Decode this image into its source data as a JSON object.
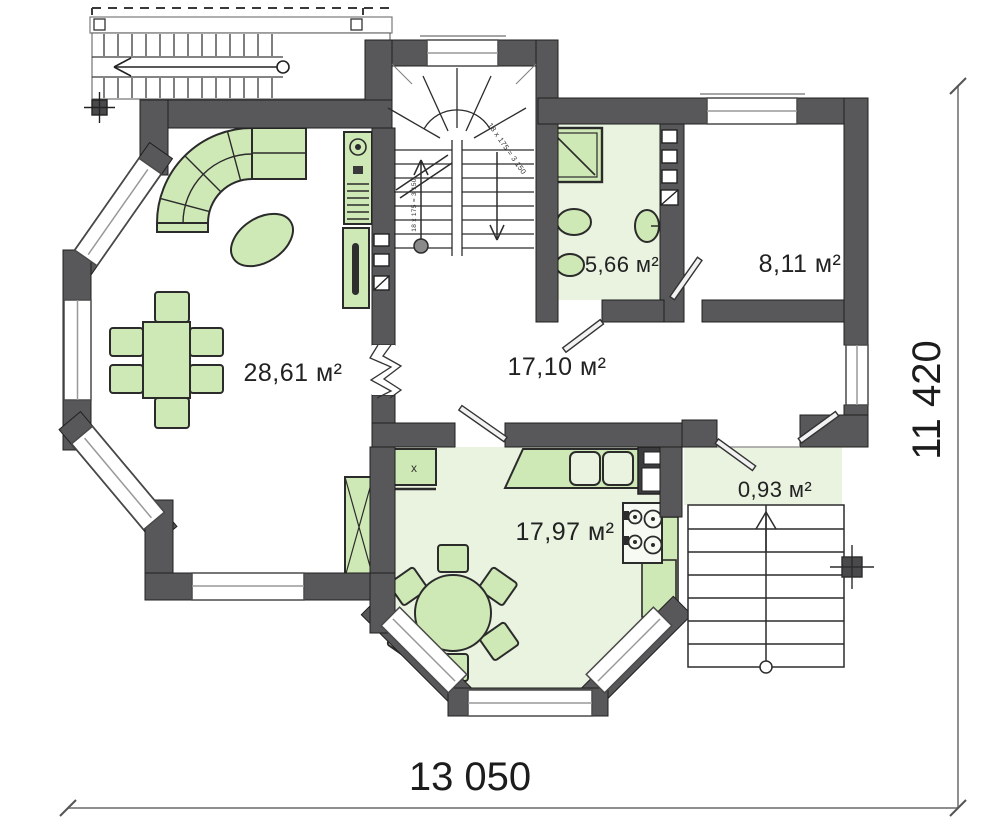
{
  "plan": {
    "rooms": [
      {
        "id": "living-room",
        "area": "28,61 м²"
      },
      {
        "id": "hallway",
        "area": "17,10 м²"
      },
      {
        "id": "bathroom",
        "area": "5,66 м²"
      },
      {
        "id": "bedroom",
        "area": "8,11 м²"
      },
      {
        "id": "kitchen",
        "area": "17,97 м²"
      },
      {
        "id": "porch",
        "area": "0,93 м²"
      }
    ],
    "dimensions": {
      "width": "13 050",
      "height": "11 420"
    },
    "stair_annotations": {
      "main": "18 x 175 = 3 150",
      "flight": "18 x 175 = 3 150"
    },
    "marks": {
      "kitchen_cabinet": "x"
    },
    "colors": {
      "wall": "#58585a",
      "floor_green": "#e9f3e0",
      "furniture_green": "#cfe9b6",
      "outline": "#2b2b2b",
      "dimension_line": "#8f8f8f"
    }
  }
}
